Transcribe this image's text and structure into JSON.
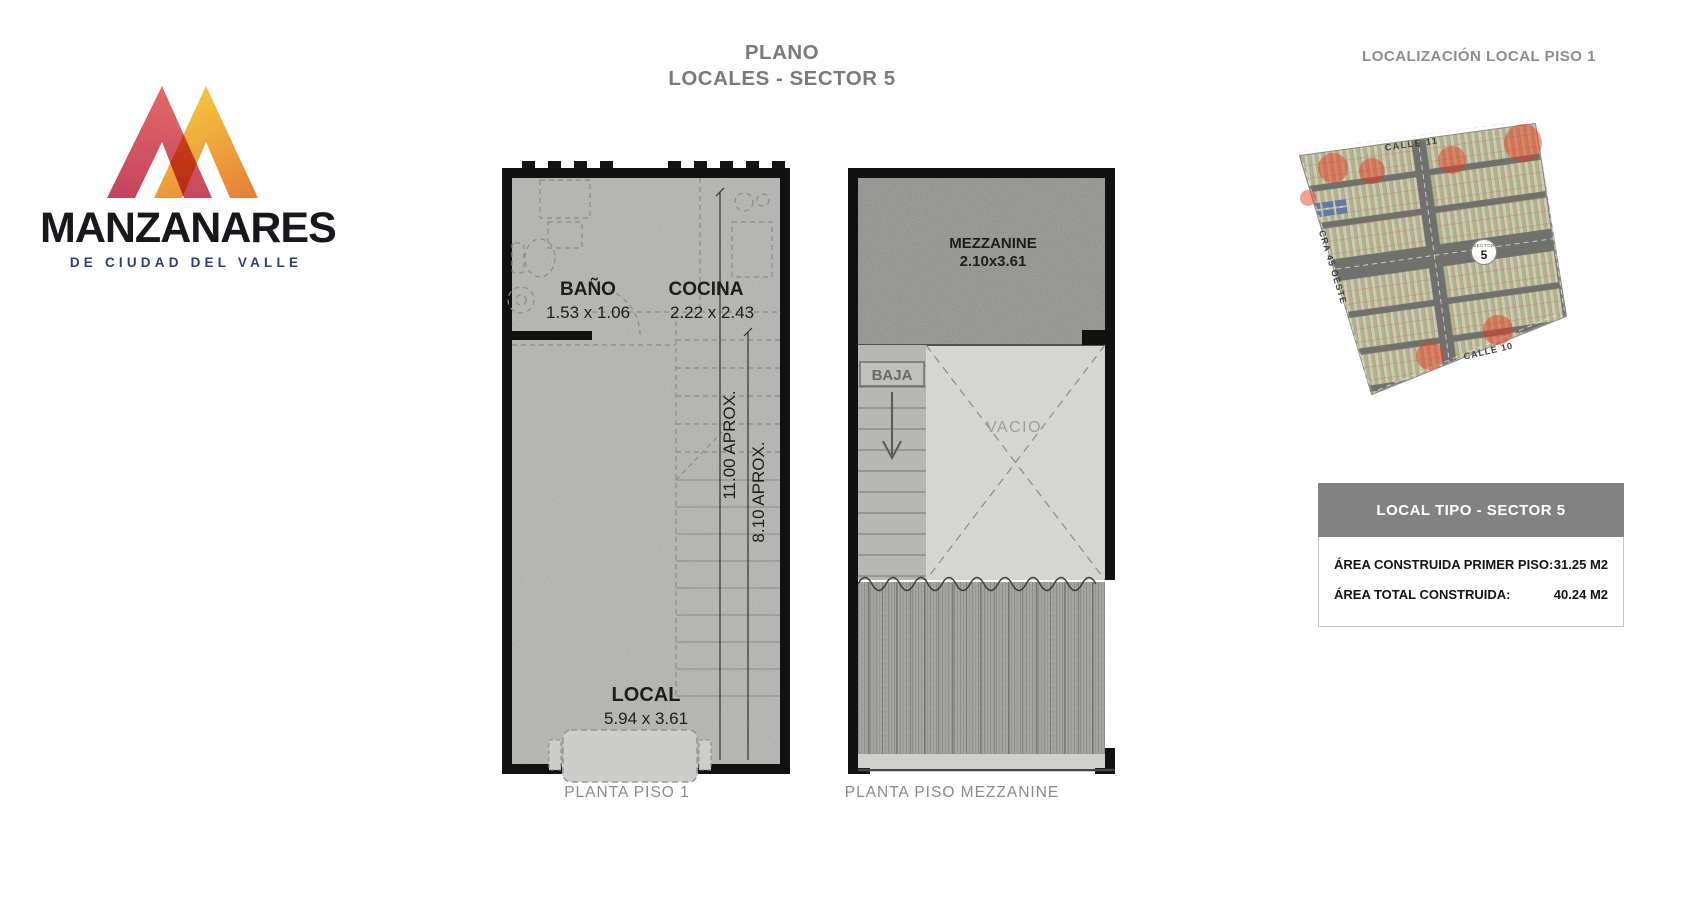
{
  "logo": {
    "brand": "MANZANARES",
    "tagline": "DE CIUDAD DEL VALLE"
  },
  "title": {
    "line1": "PLANO",
    "line2": "LOCALES - SECTOR 5"
  },
  "plan1": {
    "caption": "PLANTA PISO 1",
    "bath_label": "BAÑO",
    "bath_dims": "1.53 x 1.06",
    "kitchen_label": "COCINA",
    "kitchen_dims": "2.22 x 2.43",
    "local_label": "LOCAL",
    "local_dims": "5.94 x 3.61",
    "dim_total": "11.00 APROX.",
    "dim_partial": "8.10 APROX."
  },
  "plan2": {
    "caption": "PLANTA PISO MEZZANINE",
    "mezzanine_label": "MEZZANINE",
    "mezzanine_dims": "2.10x3.61",
    "stairs_label": "BAJA",
    "void_label": "VACIO"
  },
  "map": {
    "title": "LOCALIZACIÓN LOCAL PISO 1",
    "street_top": "CALLE 11",
    "street_left": "CRA 45 OESTE",
    "street_bottom": "CALLE 10",
    "sector_label": "SECTOR",
    "sector_number": "5"
  },
  "infobox": {
    "header": "LOCAL TIPO - SECTOR 5",
    "rows": [
      {
        "label": "ÁREA CONSTRUIDA PRIMER PISO:",
        "value": "31.25 M2"
      },
      {
        "label": "ÁREA TOTAL CONSTRUIDA:",
        "value": "40.24 M2"
      }
    ]
  },
  "colors": {
    "wall": "#111111",
    "floor": "#cbcbc9",
    "mezzanine_floor": "#b3b3b1",
    "void_floor": "#d5d5d3",
    "dash_line": "#8b8b89",
    "title_gray": "#7a7a7a",
    "header_bar": "#828282",
    "logo_red": "#c23a55",
    "logo_orange": "#e47e38",
    "logo_yellow": "#f6c83e",
    "map_highlight_red": "#e8391c",
    "tagline_navy": "#2a3f6e"
  }
}
